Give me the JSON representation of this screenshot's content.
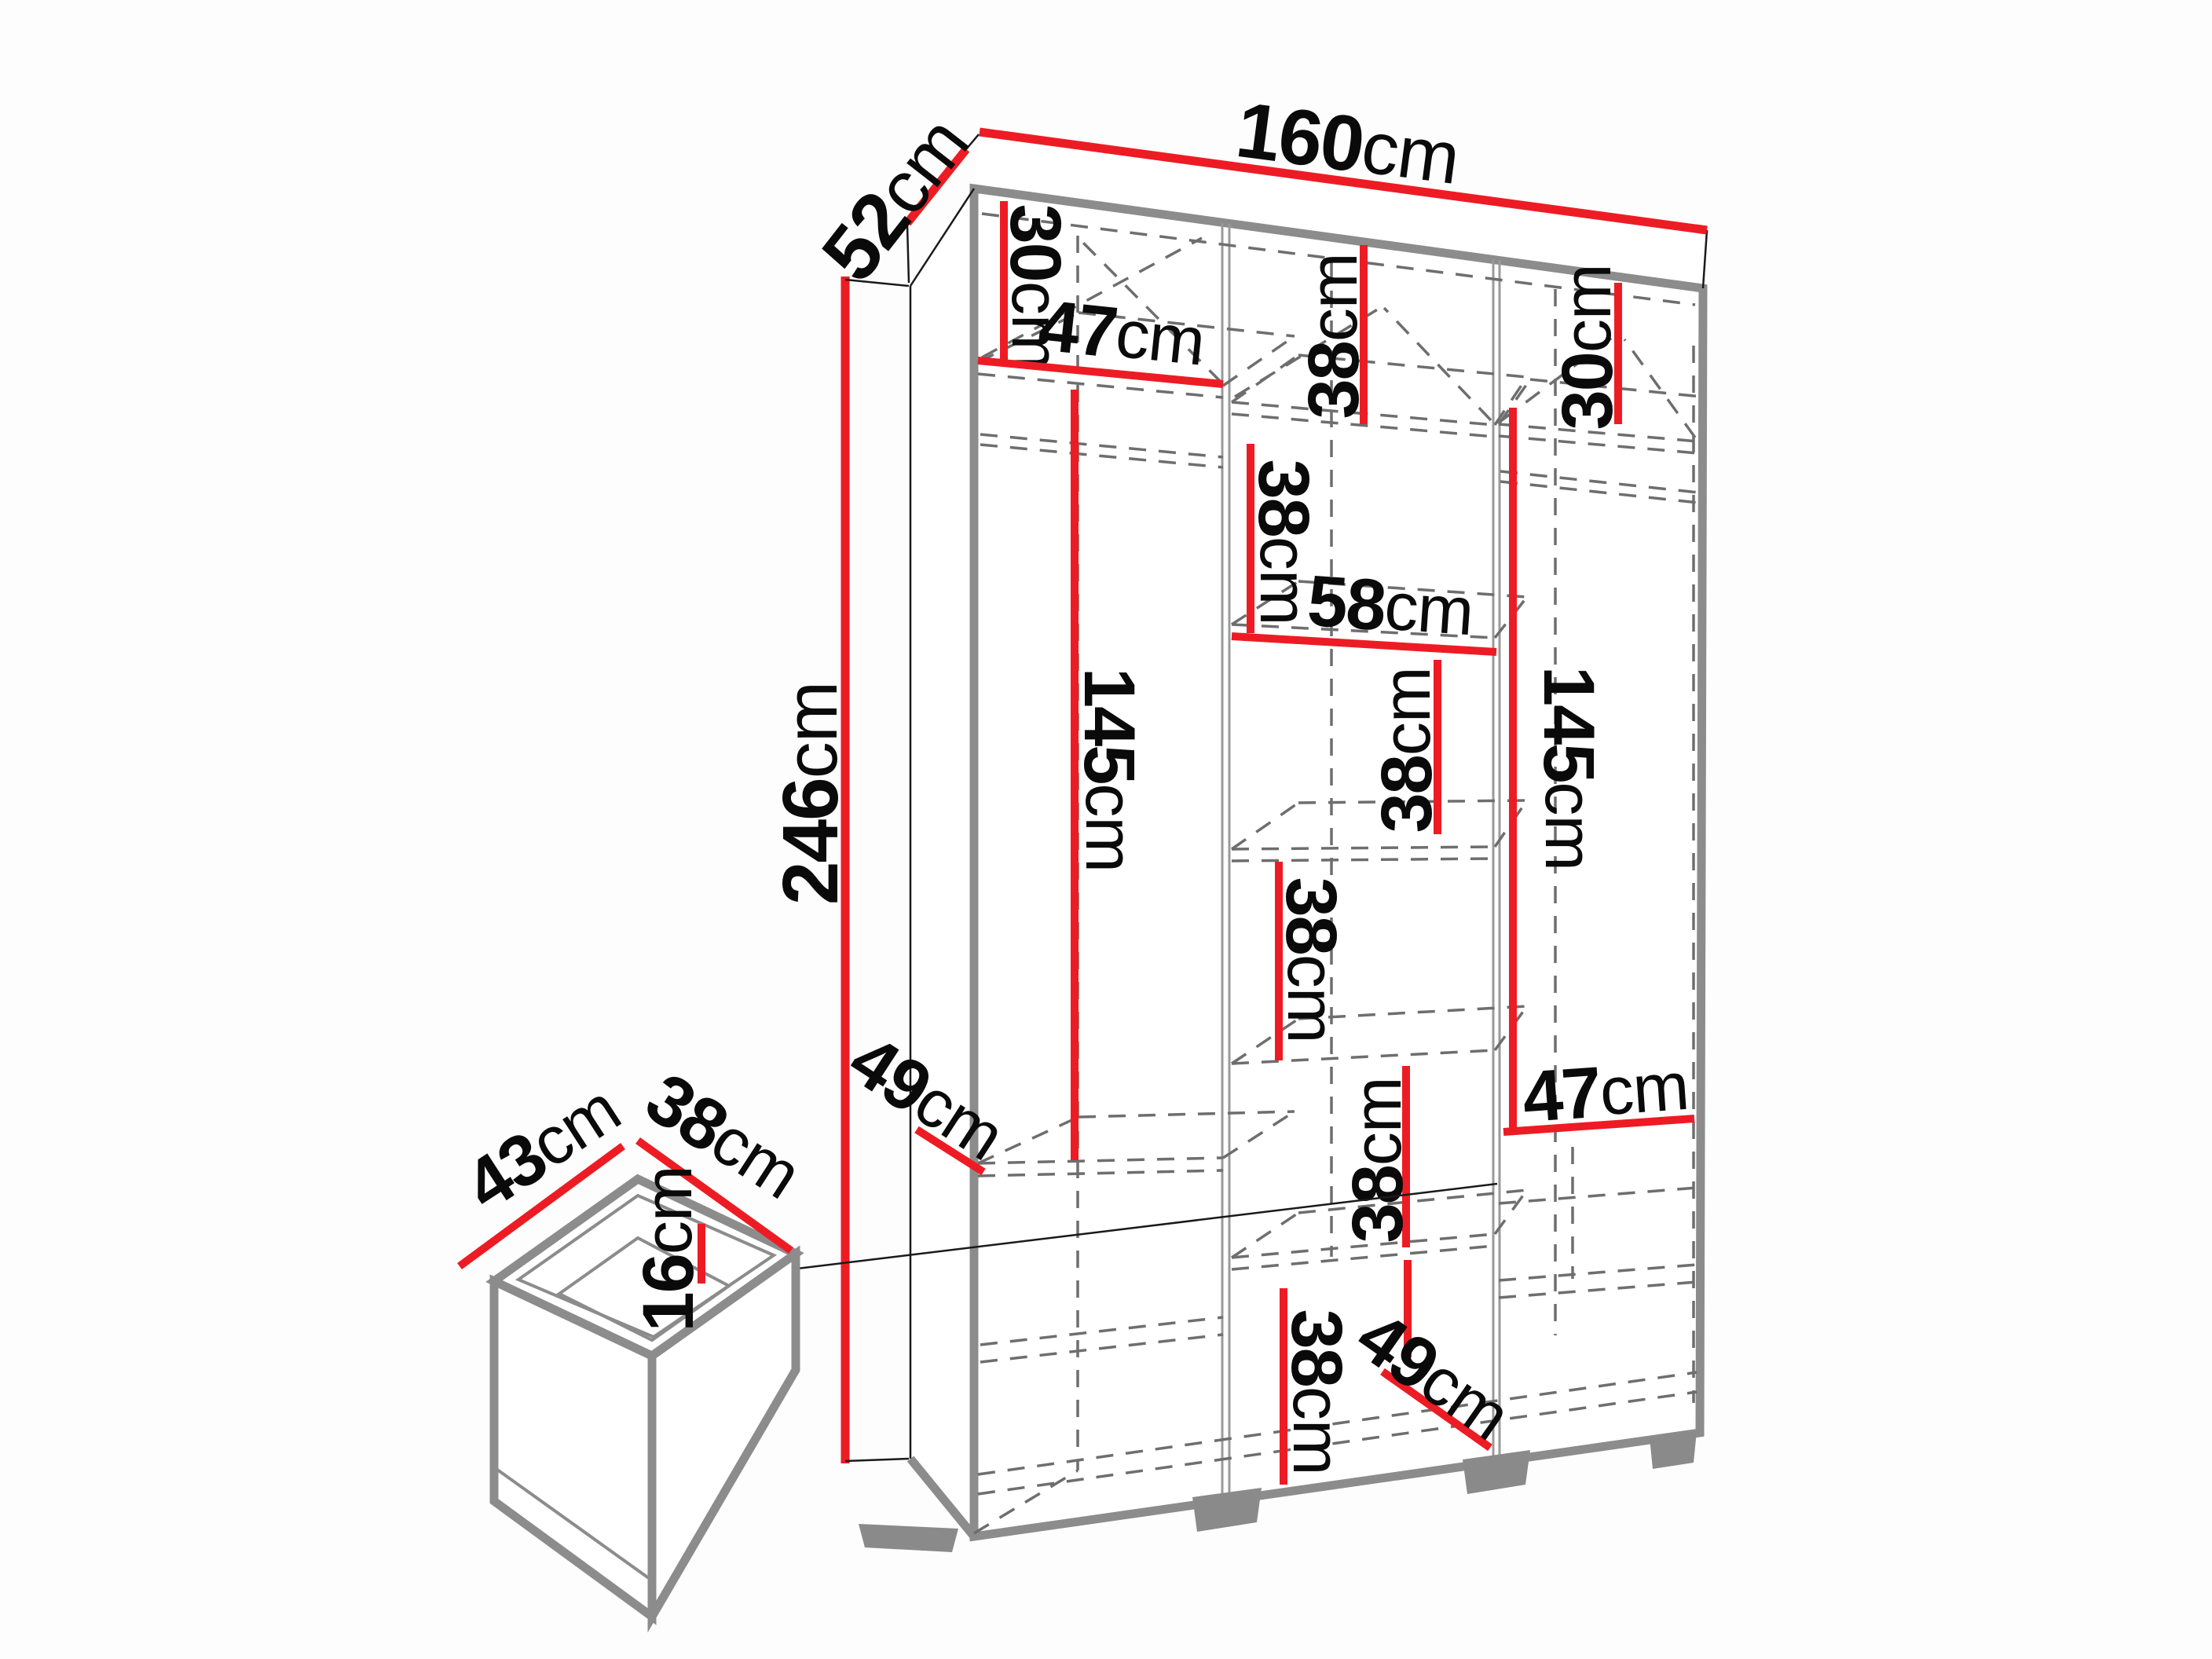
{
  "diagram_title": "wardrobe-dimensions-diagram",
  "unit": "cm",
  "dims": {
    "width160": {
      "v": "160",
      "u": "cm"
    },
    "depth52": {
      "v": "52",
      "u": "cm"
    },
    "height246": {
      "v": "246",
      "u": "cm"
    },
    "left30": {
      "v": "30",
      "u": "cm"
    },
    "left47": {
      "v": "47",
      "u": "cm"
    },
    "left145": {
      "v": "145",
      "u": "cm"
    },
    "left49": {
      "v": "49",
      "u": "cm"
    },
    "mid38top": {
      "v": "38",
      "u": "cm"
    },
    "mid38second": {
      "v": "38",
      "u": "cm"
    },
    "mid58": {
      "v": "58",
      "u": "cm"
    },
    "mid38third": {
      "v": "38",
      "u": "cm"
    },
    "mid38fourth": {
      "v": "38",
      "u": "cm"
    },
    "mid38fifth": {
      "v": "38",
      "u": "cm"
    },
    "mid38bottom": {
      "v": "38",
      "u": "cm"
    },
    "mid49": {
      "v": "49",
      "u": "cm"
    },
    "right30": {
      "v": "30",
      "u": "cm"
    },
    "right145": {
      "v": "145",
      "u": "cm"
    },
    "right47": {
      "v": "47",
      "u": "cm"
    },
    "drawer43": {
      "v": "43",
      "u": "cm"
    },
    "drawer38": {
      "v": "38",
      "u": "cm"
    },
    "drawer16": {
      "v": "16",
      "u": "cm"
    }
  },
  "colors": {
    "dimension_line": "#ED1C24",
    "frame": "#8c8c8c",
    "hidden_edge": "#6e6e6e",
    "text": "#0a0a0a"
  }
}
